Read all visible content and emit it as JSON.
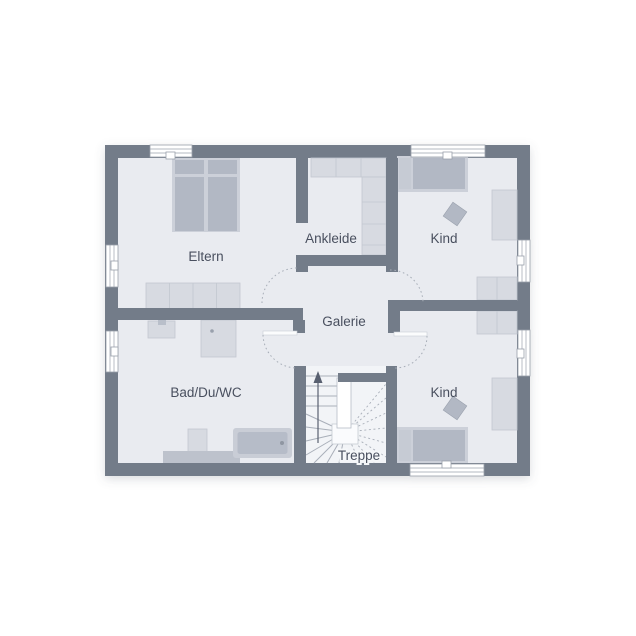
{
  "plan": {
    "rooms": {
      "eltern": {
        "label": "Eltern"
      },
      "ankleide": {
        "label": "Ankleide"
      },
      "kind_top": {
        "label": "Kind"
      },
      "galerie": {
        "label": "Galerie"
      },
      "bad": {
        "label": "Bad/Du/WC"
      },
      "kind_bottom": {
        "label": "Kind"
      },
      "treppe": {
        "label": "Treppe"
      }
    }
  },
  "colors": {
    "background": "#ffffff",
    "wall": "#737c89",
    "floor": "#e9ebf0",
    "stair_floor": "#f2f4f7",
    "label_text": "#49505e",
    "furniture_light": "#d7dae1",
    "furniture_mid": "#ccd0d9",
    "furniture_dark": "#b2b8c4",
    "furniture_stroke": "#c2c7d0",
    "window_frame": "#9aa0ab",
    "door_arc": "#a8aeb8",
    "tread_line": "#a9afb9"
  }
}
